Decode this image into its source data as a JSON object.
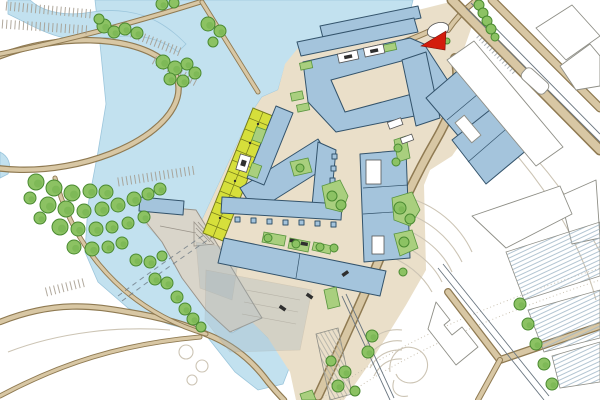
{
  "plan": {
    "type": "architectural-site-plan",
    "features": [
      "lake",
      "canal",
      "oval-park",
      "parking-lots",
      "tree-clusters",
      "pedestrian-bridge",
      "central-plaza",
      "courtyard-building",
      "linear-buildings",
      "allotment-garden-strip",
      "harbor-pier",
      "submerged-dock-remnants",
      "ferry-route-dashed",
      "main-boulevard",
      "railway-corridor",
      "existing-buildings-outline",
      "terraced-landscape-contours",
      "spiral-ramp",
      "red-landmark-marker"
    ]
  },
  "palette": {
    "background": "#ffffff",
    "water": "#c2e1ef",
    "water_edge": "#9cc6dc",
    "land": "#eadfc9",
    "road_fill": "#d8c7a4",
    "road_edge": "#8f7a52",
    "building_fill": "#a4c4dc",
    "building_outline": "#33536b",
    "existing_fill": "#ffffff",
    "existing_outline": "#8e8e86",
    "hatch_line": "#9fb6c6",
    "pier_fill": "#d9d5ca",
    "pier_outline": "#9a948a",
    "allotment_fill": "#d6df3b",
    "allotment_grid": "#787e1c",
    "tree_fill": "#8cc263",
    "tree_outline": "#4a8a31",
    "tree_shadow": "#6faf4c",
    "garden_fill": "#a9cf7e",
    "garden_outline": "#59953f",
    "marker_red": "#d31c0c",
    "rail_line": "#6a7680",
    "contour_line": "#ccc4b4",
    "parking_tick": "#a39a8c",
    "dock_overlay": "#9fb3bc",
    "car_dark": "#2f2f2f"
  }
}
